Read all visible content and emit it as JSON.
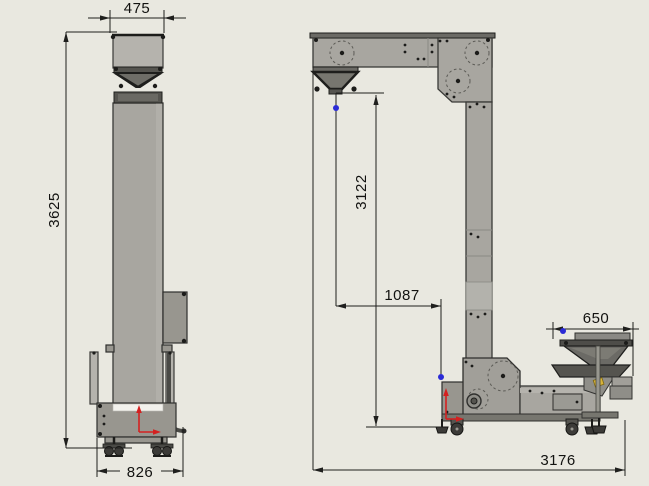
{
  "colors": {
    "background": "#e9e8e0",
    "axis_red": "#d42020",
    "point_blue": "#2b2bd6",
    "sensor_yellow": "#d8b43a"
  },
  "front_view": {
    "dimensions": {
      "top_width": "475",
      "overall_height": "3625",
      "base_width": "826"
    }
  },
  "side_view": {
    "dimensions": {
      "discharge_height": "3122",
      "inlet_offset": "1087",
      "feed_hopper_width": "650",
      "overall_length": "3176"
    }
  }
}
